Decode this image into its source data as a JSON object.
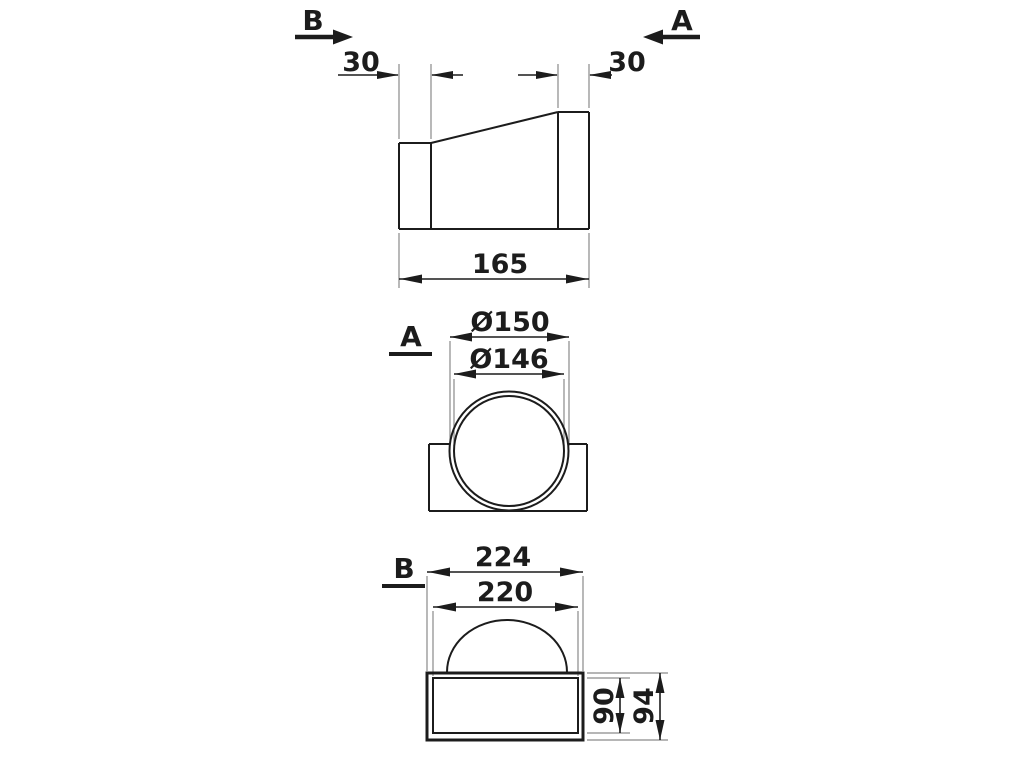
{
  "colors": {
    "line": "#1c1c1c",
    "ext": "#8a8a8a",
    "bg": "#ffffff"
  },
  "top_view": {
    "section_b_marker": "B",
    "section_a_marker": "A",
    "dim_left_collar": "30",
    "dim_right_collar": "30",
    "dim_length": "165"
  },
  "section_a": {
    "label": "A",
    "dim_outer_diameter": "Ø150",
    "dim_inner_diameter": "Ø146"
  },
  "section_b": {
    "label": "B",
    "dim_outer_width": "224",
    "dim_inner_width": "220",
    "dim_inner_height": "90",
    "dim_outer_height": "94"
  }
}
